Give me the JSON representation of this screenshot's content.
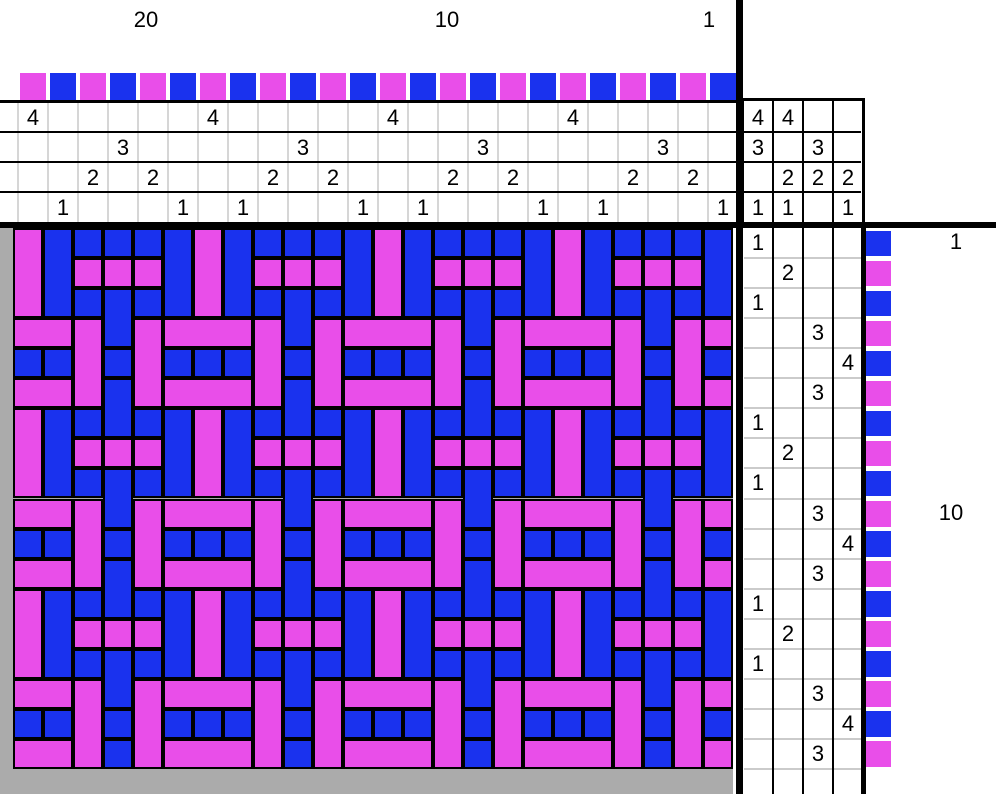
{
  "palette": {
    "magenta": "#E94EE9",
    "blue": "#1A32EE",
    "canvas_gray": "#ABABAB",
    "grid_light_gray": "#D6D6D6",
    "treadling_row_line_gray": "#CBCBCB",
    "line_black": "#000000",
    "background": "#FFFFFF"
  },
  "draft": {
    "shaft_count": 4,
    "treadle_count": 4,
    "warp_thread_count": 24,
    "weft_pick_count": 18,
    "threading_left_to_right": [
      4,
      1,
      2,
      3,
      2,
      1,
      4,
      1,
      2,
      3,
      2,
      1,
      4,
      1,
      2,
      3,
      2,
      1,
      4,
      1,
      2,
      3,
      2,
      1
    ],
    "warp_colors_left_to_right": [
      "magenta",
      "blue",
      "magenta",
      "blue",
      "magenta",
      "blue",
      "magenta",
      "blue",
      "magenta",
      "blue",
      "magenta",
      "blue",
      "magenta",
      "blue",
      "magenta",
      "blue",
      "magenta",
      "blue",
      "magenta",
      "blue",
      "magenta",
      "blue",
      "magenta",
      "blue"
    ],
    "tieup_lifts_by_treadle": [
      [
        1,
        3,
        4
      ],
      [
        1,
        2,
        4
      ],
      [
        2,
        3
      ],
      [
        1,
        2
      ]
    ],
    "treadling_top_to_bottom": [
      1,
      2,
      1,
      3,
      4,
      3,
      1,
      2,
      1,
      3,
      4,
      3,
      1,
      2,
      1,
      3,
      4,
      3
    ],
    "weft_colors_top_to_bottom": [
      "blue",
      "magenta",
      "blue",
      "magenta",
      "blue",
      "magenta",
      "blue",
      "magenta",
      "blue",
      "magenta",
      "blue",
      "magenta",
      "blue",
      "magenta",
      "blue",
      "magenta",
      "blue",
      "magenta"
    ]
  },
  "warp_number_labels": [
    {
      "text": "20",
      "x": 146,
      "y": 20
    },
    {
      "text": "10",
      "x": 447,
      "y": 20
    },
    {
      "text": "1",
      "x": 709,
      "y": 20
    }
  ],
  "weft_number_labels": [
    {
      "text": "1",
      "x": 956,
      "y": 242
    },
    {
      "text": "10",
      "x": 951,
      "y": 513
    }
  ]
}
